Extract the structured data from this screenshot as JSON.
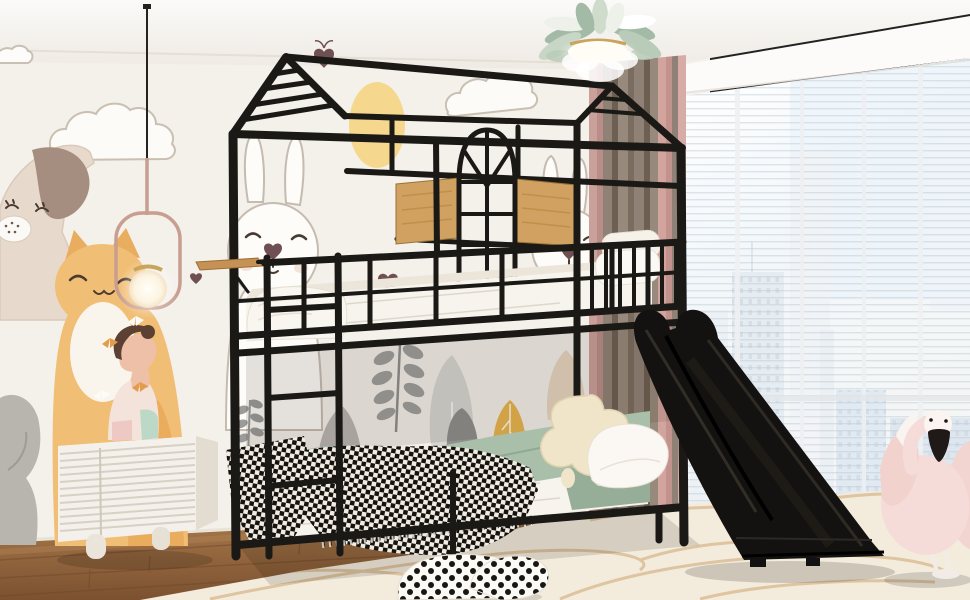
{
  "scene": {
    "description": "Product photo of a kids bedroom: black metal twin-over-twin house-frame bunk bed with attached black slide, sage green bedding and black-white checkered throw, kids wall mural with dog, cat and bunnies, white ribbed nightstand with girl figurine, feather chandelier, pendant lamp, pink flamingo plush by a bright city window, polka-dot pillow on a cream rug",
    "objects": [
      {
        "name": "house-frame-bunk-bed",
        "color": "black metal"
      },
      {
        "name": "slide",
        "color": "black"
      },
      {
        "name": "upper-mattress",
        "color": "white"
      },
      {
        "name": "lower-bedding",
        "color": "sage green duvet, black-white checkered throw"
      },
      {
        "name": "headboard-panels",
        "color": "natural oak"
      },
      {
        "name": "arched-window-grille",
        "color": "black"
      },
      {
        "name": "wall-mural",
        "color": "dog, cat, bunnies, sun, clouds, gray trees"
      },
      {
        "name": "nightstand",
        "color": "white ribbed"
      },
      {
        "name": "girl-figurine",
        "color": "cream with butterflies"
      },
      {
        "name": "pendant-lamp",
        "color": "rose frame, glowing globe"
      },
      {
        "name": "feather-chandelier",
        "color": "sage green feathers, gold stem"
      },
      {
        "name": "curtains",
        "color": "taupe and dusty pink"
      },
      {
        "name": "window-city-view",
        "color": "bright sheer, skyline"
      },
      {
        "name": "flamingo-plush",
        "color": "pink"
      },
      {
        "name": "polka-dot-pillow",
        "color": "white with black dots"
      },
      {
        "name": "rug",
        "color": "cream with tan swirls"
      },
      {
        "name": "floor",
        "color": "brown wood planks"
      }
    ]
  },
  "palette": {
    "wall": "#f4f0ea",
    "ceiling": "#f9f7f4",
    "frame_black": "#1b1916",
    "wood_panel": "#d0a160",
    "mattress_white": "#f7f4ee",
    "duvet_sage": "#a9bfa9",
    "duvet_sage_dark": "#96ad97",
    "curtain_taupe": "#8a7c6e",
    "curtain_pink": "#d8aca6",
    "window_sky": "#e3eef7",
    "floor_wood": "#a5754a",
    "floor_wood_dark": "#7c5230",
    "rug_cream": "#f3ebdc",
    "rug_swirl": "#dcc09a",
    "flamingo_pink": "#f6dcd8",
    "mural_orange": "#f1be75",
    "mural_yellow": "#f5d88e",
    "mural_gray": "#9b9b99",
    "mural_outline": "#c9bfb2",
    "heart_brown": "#6f5052",
    "dresser_white": "#f4f1ec",
    "gold": "#c9a45b",
    "lamp_rose": "#c79e8f",
    "mint": "#bcd8c6",
    "plush_cream": "#f0e5c9"
  }
}
